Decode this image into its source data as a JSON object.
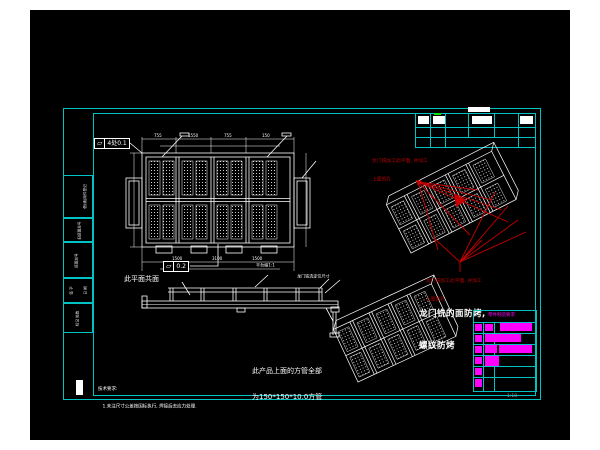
{
  "colors": {
    "background": "#000000",
    "frame_cyan": "#00c2c2",
    "line_white": "#ffffff",
    "annotation_red": "#b40000",
    "highlight_magenta": "#ff00ff",
    "tick_green": "#00e000"
  },
  "revision_strip": {
    "cells": [
      {
        "label": "借(通)用件登记",
        "sub": "签字 日期"
      },
      {
        "label": "旧底图总号",
        "sub": "签字"
      },
      {
        "label": "底图总号",
        "sub": "日期"
      },
      {
        "label": "签 字",
        "sub": "日 期"
      },
      {
        "label": "标记 处数",
        "sub": "分区"
      }
    ]
  },
  "callouts": {
    "flatness_a": {
      "symbol": "▱",
      "value": "4处0.1"
    },
    "flatness_b": {
      "symbol": "▱",
      "value": "0.2"
    }
  },
  "plan_view": {
    "dims_top": [
      "755",
      "1550",
      "755",
      "150"
    ],
    "dims_bottom": [
      "1500",
      "3100",
      "1500"
    ],
    "label_coplanar": "此平面共面",
    "label_platform": "平台缩1:1",
    "label_longmen": "龙门铣选定位尺寸"
  },
  "notes": {
    "red_top": [
      "龙门铣加工此平面, 并加工",
      "上面的孔"
    ],
    "red_mid": [
      "龙门铣加工此平面, 并加工",
      "上面的孔"
    ],
    "face_bake": [
      "龙门铣的面防烤,",
      "螺纹防烤"
    ],
    "square_tube": [
      "此产品上面的方管全部",
      "为150*150*10.0方管"
    ],
    "tech": [
      "技术要求:",
      "1.未注尺寸公差按国标执行, 焊接后去应力处理."
    ]
  },
  "title_block": {
    "header": "零件制造要求",
    "scale_label": "1:10"
  }
}
